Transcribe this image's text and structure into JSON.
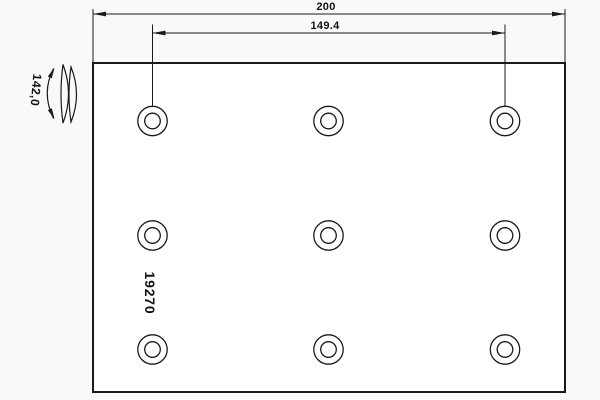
{
  "drawing": {
    "part_number": "19270",
    "dimensions": {
      "overall_width": "200",
      "hole_spacing": "149.4",
      "curve_radius": "142,0"
    },
    "holes": {
      "rows": 3,
      "cols": 3,
      "count": 9
    },
    "colors": {
      "line": "#1a1a1a",
      "text": "#111111",
      "background": "#f9f9f7",
      "plate_fill": "#ffffff"
    }
  }
}
